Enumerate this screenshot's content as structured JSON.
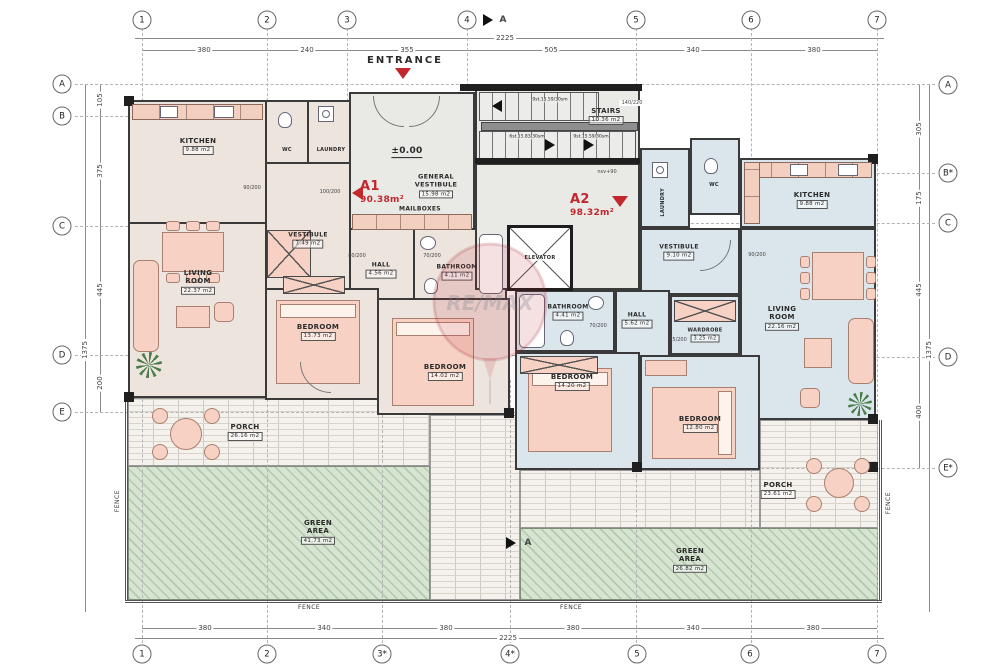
{
  "grid": {
    "top": {
      "bubbles": [
        "1",
        "2",
        "3",
        "4",
        "5",
        "6",
        "7"
      ],
      "dims": [
        "380",
        "240",
        "355",
        "505",
        "340",
        "380"
      ],
      "total": "2225"
    },
    "bottom": {
      "bubbles": [
        "1",
        "2",
        "3*",
        "4*",
        "5",
        "6",
        "7"
      ],
      "dims": [
        "380",
        "340",
        "380",
        "380",
        "340",
        "380"
      ],
      "total": "2225"
    },
    "left": {
      "bubbles": [
        "A",
        "B",
        "C",
        "D",
        "E"
      ],
      "dims": [
        "105",
        "375",
        "445",
        "200"
      ],
      "total": "1375"
    },
    "right": {
      "bubbles": [
        "A",
        "B*",
        "C",
        "D",
        "E*"
      ],
      "dims": [
        "305",
        "175",
        "445",
        "400"
      ],
      "total": "1375"
    }
  },
  "header": {
    "entrance": "ENTRANCE",
    "section_marker": "A"
  },
  "units": {
    "a1": {
      "id": "A1",
      "area": "90.38m²"
    },
    "a2": {
      "id": "A2",
      "area": "98.32m²"
    }
  },
  "common": {
    "general_vestibule": {
      "name": "GENERAL VESTIBULE",
      "area": "15.98 m2"
    },
    "mailboxes": "MAILBOXES",
    "elevator": "ELEVATOR",
    "level_zero": "±0.00",
    "stairs": {
      "name": "STAIRS",
      "area": "10.36 m2",
      "flight_up": "9st.15.59/30sm",
      "flight_a": "6st.15.83/30sm",
      "flight_b": "9st.15.59/30sm",
      "opening": "140/220",
      "level": "nsv+90"
    }
  },
  "a1_rooms": {
    "kitchen": {
      "name": "KITCHEN",
      "area": "9.88 m2"
    },
    "wc": {
      "name": "WC"
    },
    "laundry": {
      "name": "LAUNDRY"
    },
    "living": {
      "name": "LIVING ROOM",
      "area": "22.37 m2"
    },
    "vestibule": {
      "name": "VESTIBULE",
      "area": "7.49 m2"
    },
    "hall": {
      "name": "HALL",
      "area": "4.56 m2"
    },
    "bathroom": {
      "name": "BATHROOM",
      "area": "4.11 m2"
    },
    "bedroom1": {
      "name": "BEDROOM",
      "area": "13.73 m2"
    },
    "bedroom2": {
      "name": "BEDROOM",
      "area": "14.02 m2"
    }
  },
  "a2_rooms": {
    "laundry": {
      "name": "LAUNDRY"
    },
    "wc": {
      "name": "WC"
    },
    "kitchen": {
      "name": "KITCHEN",
      "area": "9.88 m2"
    },
    "living": {
      "name": "LIVING ROOM",
      "area": "22.16 m2"
    },
    "vestibule": {
      "name": "VESTIBULE",
      "area": "9.10 m2"
    },
    "hall": {
      "name": "HALL",
      "area": "5.62 m2"
    },
    "wardrobe": {
      "name": "WARDROBE",
      "area": "3.25 m2"
    },
    "bathroom": {
      "name": "BATHROOM",
      "area": "4.41 m2"
    },
    "bedroom1": {
      "name": "BEDROOM",
      "area": "14.20 m2"
    },
    "bedroom2": {
      "name": "BEDROOM",
      "area": "12.80 m2"
    }
  },
  "outdoor": {
    "porch_left": {
      "name": "PORCH",
      "area": "26.16 m2"
    },
    "porch_right": {
      "name": "PORCH",
      "area": "23.61 m2"
    },
    "green_left": {
      "name": "GREEN AREA",
      "area": "41.73 m2"
    },
    "green_right": {
      "name": "GREEN AREA",
      "area": "26.82 m2"
    },
    "fence": "FENCE"
  },
  "door_tags": [
    "90/200",
    "100/200",
    "80/200",
    "70/200",
    "70/200",
    "75/200",
    "90/200"
  ],
  "watermark": "RE/MAX",
  "colors": {
    "accent_red": "#c1272d",
    "a1_fill": "#ece4dd",
    "a2_fill": "#dbe6ec",
    "green_fill": "#d6e4d1",
    "wall": "#3a3a3a"
  }
}
